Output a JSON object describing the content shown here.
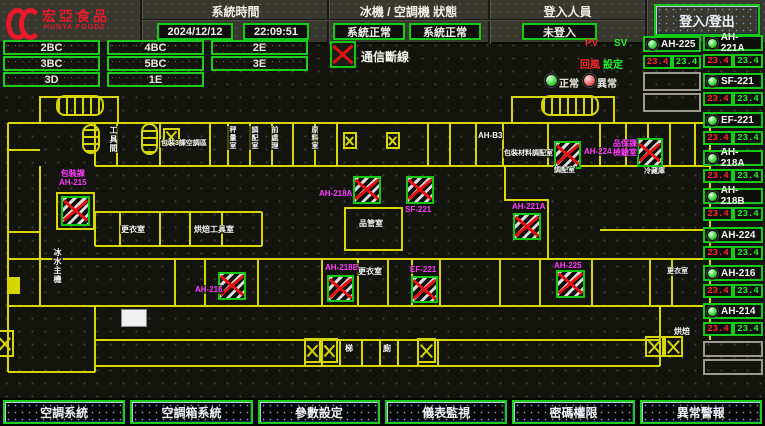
{
  "header": {
    "brand": "宏亞食品",
    "brand_en": "HUNYA FOODS",
    "system_time_label": "系統時間",
    "date": "2024/12/12",
    "time": "22:09:51",
    "status_label": "冰機 / 空調機 狀態",
    "chiller_status": "系統正常",
    "ahu_status": "系統正常",
    "login_label": "登入人員",
    "login_status": "未登入",
    "login_button": "登入/登出"
  },
  "floor_buttons": [
    "2BC",
    "4BC",
    "2E",
    "3BC",
    "5BC",
    "3E",
    "3D",
    "1E"
  ],
  "legend": {
    "comm_fail": "通信斷線",
    "pv": "PV",
    "sv": "SV",
    "return_air": "回風",
    "setpoint": "設定",
    "normal": "正常",
    "abnormal": "異常"
  },
  "equipment_left": {
    "name": "AH-225",
    "pv": "23.4",
    "sv": "23.4"
  },
  "equipment": [
    {
      "name": "AH-221A",
      "pv": "23.4",
      "sv": "23.4"
    },
    {
      "name": "SF-221",
      "pv": "23.4",
      "sv": "23.4"
    },
    {
      "name": "EF-221",
      "pv": "23.4",
      "sv": "23.4"
    },
    {
      "name": "AH-218A",
      "pv": "23.4",
      "sv": "23.4"
    },
    {
      "name": "AH-218B",
      "pv": "23.4",
      "sv": "23.4"
    },
    {
      "name": "AH-224",
      "pv": "23.4",
      "sv": "23.4"
    },
    {
      "name": "AH-216",
      "pv": "23.4",
      "sv": "23.4"
    },
    {
      "name": "AH-214",
      "pv": "23.4",
      "sv": "23.4"
    }
  ],
  "map": {
    "devices": [
      {
        "l1": "包裝課",
        "l2": "AH-215"
      },
      {
        "l1": "AH-218A"
      },
      {
        "l1": "SF-221"
      },
      {
        "l1": "AH-224"
      },
      {
        "l1": "品保課",
        "l2": "檢驗室"
      },
      {
        "l1": "AH-221A"
      },
      {
        "l1": "AH-225"
      },
      {
        "l1": "AH-218B"
      },
      {
        "l1": "EF-221"
      },
      {
        "l1": "AH-216"
      }
    ],
    "rooms": [
      "工具間",
      "包裝3課空調區",
      "秤量室",
      "調配室",
      "前處理",
      "原料室",
      "AH-B3",
      "包裝材料調配室",
      "調配室",
      "冷藏庫",
      "更衣室",
      "烘焙工具室",
      "品管室",
      "更衣室",
      "冰水主機",
      "更衣室",
      "烘焙",
      "梯",
      "廁"
    ]
  },
  "footer_buttons": [
    "空調系統",
    "空調箱系統",
    "參數設定",
    "儀表監視",
    "密碼權限",
    "異常警報"
  ],
  "colors": {
    "wall": "#d6d600",
    "ok_green": "#17c917",
    "alarm_red": "#e31212",
    "device_magenta": "#ff3cff",
    "brand_red": "#e8192c"
  }
}
